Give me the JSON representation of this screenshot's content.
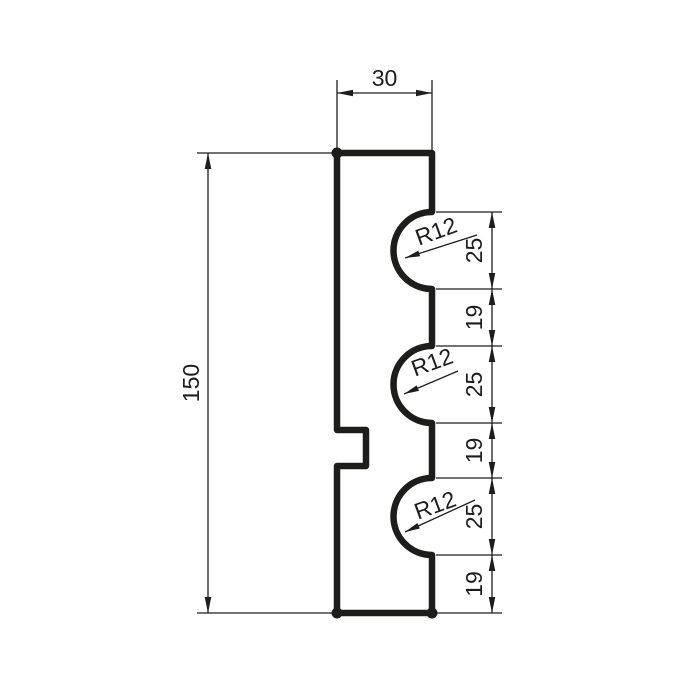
{
  "drawing": {
    "description": "Technical cross-section drawing of a molding profile with three semicircular flutes",
    "canvas": {
      "width": 686,
      "height": 686,
      "background": "#ffffff",
      "line_color": "#1d1d1b"
    },
    "profile": {
      "left": 337,
      "right": 432,
      "top": 153,
      "bottom": 613,
      "outline_stroke_width": 6.5,
      "flute_radius_px": 38.5,
      "flutes_right_cy": [
        250.5,
        384.5,
        516.5
      ],
      "left_notch": {
        "x1": 337,
        "x2": 366,
        "y1": 430,
        "y2": 466
      },
      "corner_dots": [
        [
          337,
          153
        ],
        [
          337,
          613
        ],
        [
          432,
          613
        ]
      ],
      "corner_dot_radius": 5.5
    },
    "thin_stroke_width": 1.3,
    "arrow": {
      "length": 16,
      "half_width": 3.3,
      "leader_length": 15,
      "leader_half_width": 3
    },
    "dimensions": {
      "top": {
        "label": "30",
        "value": 30,
        "line": {
          "y": 93,
          "x1": 337,
          "x2": 432
        },
        "extension_lines": [
          [
            337,
            80,
            337,
            150
          ],
          [
            432,
            80,
            432,
            150
          ]
        ],
        "text": {
          "x": 384.5,
          "y": 86
        }
      },
      "left": {
        "label": "150",
        "value": 150,
        "line": {
          "x": 208,
          "y1": 153,
          "y2": 613
        },
        "extension_lines": [
          [
            197,
            153,
            337,
            153
          ],
          [
            197,
            613,
            337,
            613
          ]
        ],
        "text": {
          "x": 191,
          "y": 383,
          "rotation": -90
        }
      },
      "right": {
        "line_x": 492,
        "ext_x1": 436,
        "ext_x2": 502,
        "boundaries": [
          212,
          289,
          346,
          423,
          478,
          555,
          613
        ],
        "segments": [
          {
            "label": "25",
            "value": 25
          },
          {
            "label": "19",
            "value": 19
          },
          {
            "label": "25",
            "value": 25
          },
          {
            "label": "19",
            "value": 19
          },
          {
            "label": "25",
            "value": 25
          },
          {
            "label": "19",
            "value": 19
          }
        ],
        "text_x": 474,
        "text_rotation": -90
      },
      "radius_callouts": [
        {
          "label": "R12",
          "value": 12,
          "text": {
            "x": 436,
            "y": 231,
            "rotation": -20
          },
          "leader": {
            "x1": 477,
            "y1": 235,
            "x2": 405,
            "y2": 258
          }
        },
        {
          "label": "R12",
          "value": 12,
          "text": {
            "x": 432,
            "y": 362,
            "rotation": -20
          },
          "leader": {
            "x1": 458,
            "y1": 371,
            "x2": 404,
            "y2": 394
          }
        },
        {
          "label": "R12",
          "value": 12,
          "text": {
            "x": 435,
            "y": 505,
            "rotation": -20
          },
          "leader": {
            "x1": 475,
            "y1": 500,
            "x2": 405,
            "y2": 532
          }
        }
      ]
    },
    "dimensions_summary": {
      "overall_width": 30,
      "overall_height": 150,
      "flute_radius": 12,
      "right_edge_segments_top_to_bottom": [
        25,
        19,
        25,
        19,
        25,
        19
      ]
    }
  }
}
